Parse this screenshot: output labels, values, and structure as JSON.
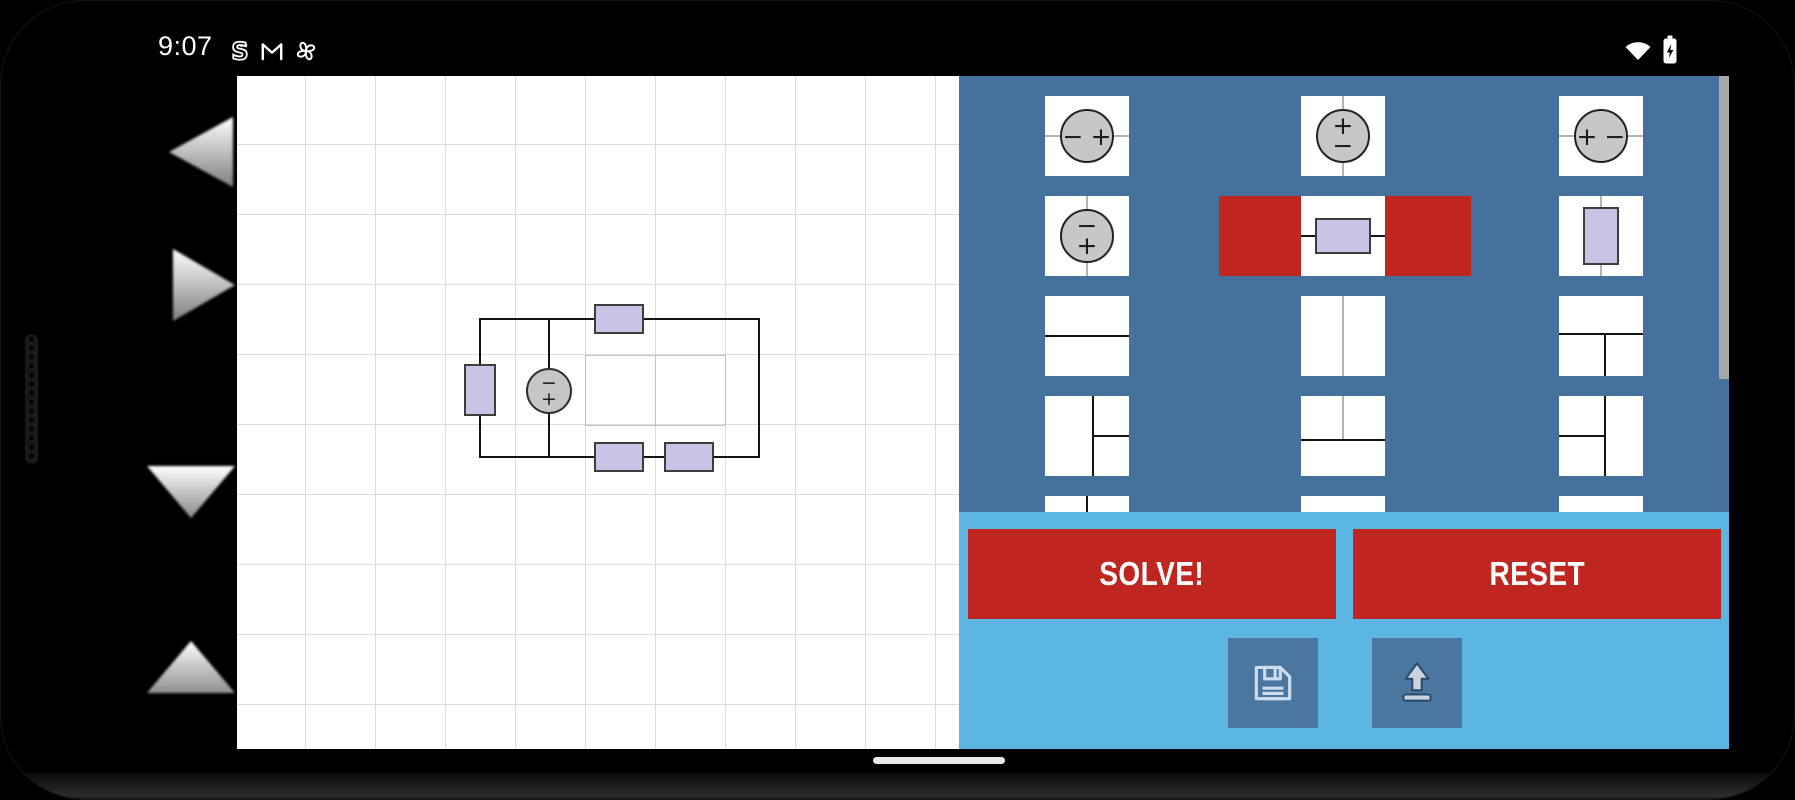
{
  "status_bar": {
    "time": "9:07",
    "notification_icons": [
      "s-bot",
      "gmail",
      "pinwheel"
    ],
    "system_icons": [
      "wifi",
      "battery-charging"
    ]
  },
  "glyphs": {
    "plus": "+",
    "minus": "−"
  },
  "left_nav": {
    "arrows": [
      "scroll-left",
      "scroll-right",
      "scroll-down",
      "scroll-up"
    ]
  },
  "canvas": {
    "type": "circuit-grid",
    "circuit": {
      "components": [
        {
          "type": "resistor",
          "orientation": "horizontal",
          "location": "top-wire"
        },
        {
          "type": "resistor",
          "orientation": "vertical",
          "location": "left-wire"
        },
        {
          "type": "voltage-source",
          "orientation": "vertical",
          "polarity": "minus-top-plus-bottom",
          "location": "middle-branch"
        },
        {
          "type": "resistor",
          "orientation": "horizontal",
          "location": "bottom-wire-1"
        },
        {
          "type": "resistor",
          "orientation": "horizontal",
          "location": "bottom-wire-2"
        }
      ],
      "highlighted_empty_cells": 2
    }
  },
  "palette": {
    "selected_tile": "resistor-horizontal",
    "rows": [
      [
        "voltage-source-horizontal-minus-plus",
        "voltage-source-vertical-plus-minus",
        "voltage-source-horizontal-plus-minus"
      ],
      [
        "voltage-source-vertical-minus-plus",
        "resistor-horizontal",
        "resistor-vertical"
      ],
      [
        "wire-horizontal",
        "wire-vertical",
        "wire-tee-down"
      ],
      [
        "wire-tee-right",
        "wire-tee-up",
        "wire-tee-left"
      ],
      [
        "wire-vertical-partial",
        "tile-partial",
        "tile-partial"
      ]
    ]
  },
  "actions": {
    "solve": "SOLVE!",
    "reset": "RESET",
    "save_icon": "floppy-disk",
    "upload_icon": "upload-arrow"
  },
  "colors": {
    "panel_blue": "#45719c",
    "section_blue": "#5cb6e3",
    "accent_red": "#bf261f",
    "resistor_purple": "#c9c3e6",
    "source_gray": "#c6c6c6"
  },
  "home_indicator": "pill"
}
